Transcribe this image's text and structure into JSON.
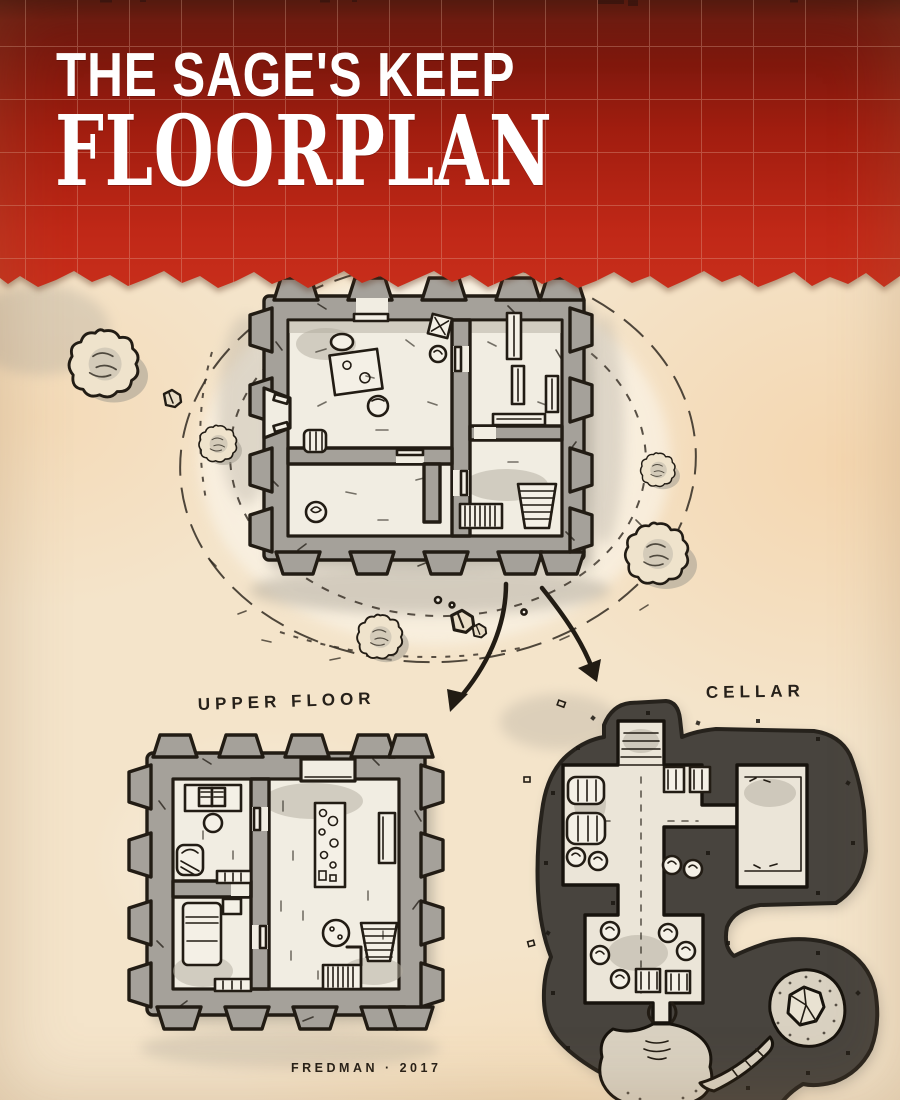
{
  "header": {
    "kicker": "THE SAGE'S KEEP",
    "title": "FLOORPLAN",
    "colors": {
      "banner_dark": "#4a0d07",
      "banner_mid": "#a11d0f",
      "banner_bright": "#c62d19",
      "grid_line": "#e7b49e",
      "text": "#ffffff"
    }
  },
  "map": {
    "labels": {
      "upper_floor": "UPPER FLOOR",
      "cellar": "CELLAR"
    },
    "signature": "FREDMAN · 2017",
    "colors": {
      "parchment": "#f4e4ca",
      "ink": "#221c14",
      "wall_gray": "#a5a19a",
      "floor_light": "#f1ede2",
      "shade_gray": "#b2ab9e",
      "rock_dark": "#48443e",
      "cave_floor": "#d9d1c1"
    },
    "plans": [
      {
        "id": "ground-floor",
        "features": [
          "splayed entrance",
          "hall with table and stool",
          "store room with barrel and pot",
          "library shelves",
          "crate",
          "stairs up",
          "hatched stairs down"
        ]
      },
      {
        "id": "upper-floor",
        "features": [
          "study desk with open book",
          "armchair",
          "shelves",
          "bed and nightstand",
          "laboratory table",
          "wall bench",
          "round rug",
          "stairs"
        ]
      },
      {
        "id": "cellar",
        "features": [
          "stairs up",
          "barrels",
          "crates",
          "sacks",
          "side vault",
          "narrow passage",
          "natural cave",
          "boulder",
          "pool"
        ]
      }
    ],
    "scenery": [
      "bushes",
      "rocks",
      "contour-rings",
      "guide-arrows"
    ]
  }
}
